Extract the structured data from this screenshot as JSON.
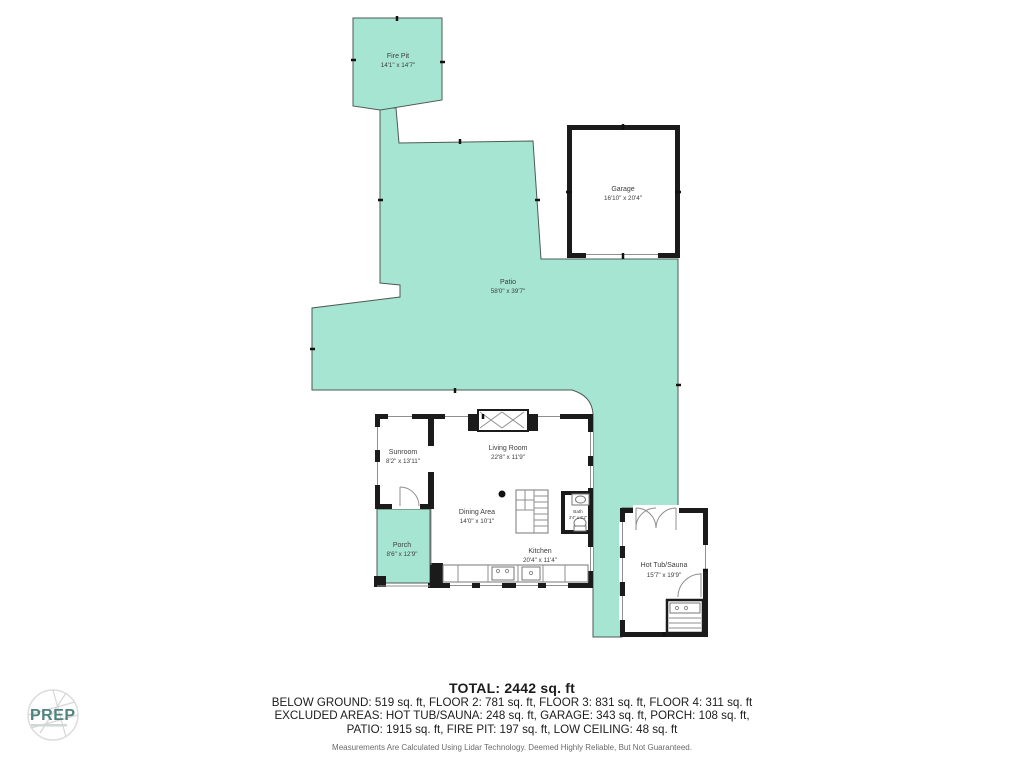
{
  "colors": {
    "patio_fill": "#a7e5d3",
    "wall": "#1b1b1b",
    "label": "#3d3d3d",
    "logo_text": "#4f837d"
  },
  "plan": {
    "rooms": {
      "fire_pit": {
        "name": "Fire Pit",
        "dims": "14'1\" x 14'7\""
      },
      "patio": {
        "name": "Patio",
        "dims": "58'0\" x 39'7\""
      },
      "garage": {
        "name": "Garage",
        "dims": "16'10\" x 20'4\""
      },
      "sunroom": {
        "name": "Sunroom",
        "dims": "8'2\" x 13'11\""
      },
      "living_room": {
        "name": "Living Room",
        "dims": "22'8\" x 11'9\""
      },
      "dining_area": {
        "name": "Dining Area",
        "dims": "14'0\" x 10'1\""
      },
      "kitchen": {
        "name": "Kitchen",
        "dims": "20'4\" x 11'4\""
      },
      "bath": {
        "name": "Bath",
        "dims": "3'4\" x 6'2\""
      },
      "porch": {
        "name": "Porch",
        "dims": "8'6\" x 12'9\""
      },
      "hot_tub_sauna": {
        "name": "Hot Tub/Sauna",
        "dims": "15'7\" x 19'9\""
      }
    }
  },
  "summary": {
    "total": "TOTAL: 2442 sq. ft",
    "line1": "BELOW GROUND: 519 sq. ft, FLOOR 2: 781 sq. ft, FLOOR 3: 831 sq. ft, FLOOR 4: 311 sq. ft",
    "line2": "EXCLUDED AREAS: HOT TUB/SAUNA: 248 sq. ft, GARAGE: 343 sq. ft, PORCH: 108 sq. ft,",
    "line3": "PATIO: 1915 sq. ft, FIRE PIT: 197 sq. ft, LOW CEILING: 48 sq. ft",
    "disclaimer": "Measurements Are Calculated Using Lidar Technology. Deemed Highly Reliable, But Not Guaranteed."
  },
  "logo": {
    "text": "PREP"
  }
}
